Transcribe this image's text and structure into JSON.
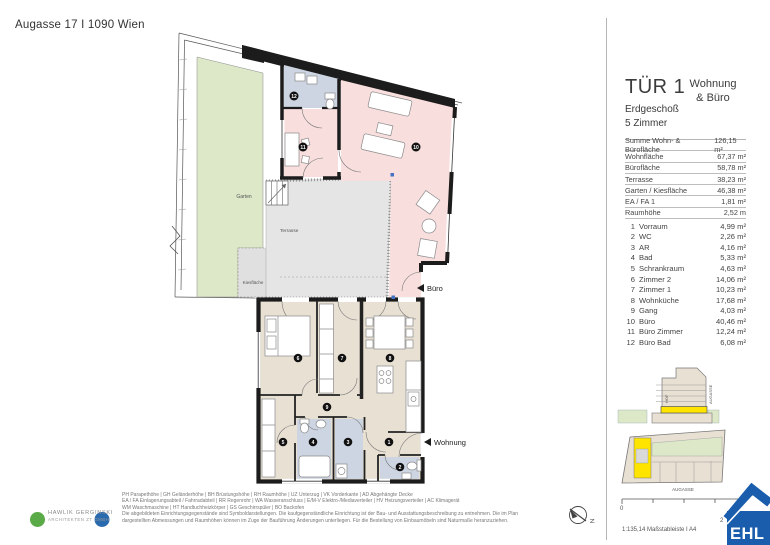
{
  "address": "Augasse 17 I 1090 Wien",
  "panel": {
    "tuer": "TÜR 1",
    "type_line1": "Wohnung",
    "type_line2": "& Büro",
    "floor": "Erdgeschoß",
    "rooms": "5 Zimmer",
    "summary": [
      {
        "label": "Summe Wohn- & Bürofläche",
        "value": "126,15 m²"
      },
      {
        "label": "Wohnfläche",
        "value": "67,37 m²"
      },
      {
        "label": "Bürofläche",
        "value": "58,78 m²"
      },
      {
        "label": "Terrasse",
        "value": "38,23 m²"
      },
      {
        "label": "Garten / Kiesfläche",
        "value": "46,38 m²"
      },
      {
        "label": "EA / FA 1",
        "value": "1,81 m²"
      },
      {
        "label": "Raumhöhe",
        "value": "2,52 m"
      }
    ],
    "room_list": [
      {
        "num": "1",
        "name": "Vorraum",
        "value": "4,99 m²"
      },
      {
        "num": "2",
        "name": "WC",
        "value": "2,26 m²"
      },
      {
        "num": "3",
        "name": "AR",
        "value": "4,16 m²"
      },
      {
        "num": "4",
        "name": "Bad",
        "value": "5,33 m²"
      },
      {
        "num": "5",
        "name": "Schrankraum",
        "value": "4,63 m²"
      },
      {
        "num": "6",
        "name": "Zimmer 2",
        "value": "14,06 m²"
      },
      {
        "num": "7",
        "name": "Zimmer 1",
        "value": "10,23 m²"
      },
      {
        "num": "8",
        "name": "Wohnküche",
        "value": "17,68 m²"
      },
      {
        "num": "9",
        "name": "Gang",
        "value": "4,03 m²"
      },
      {
        "num": "10",
        "name": "Büro",
        "value": "40,46 m²"
      },
      {
        "num": "11",
        "name": "Büro Zimmer",
        "value": "12,24 m²"
      },
      {
        "num": "12",
        "name": "Büro Bad",
        "value": "6,08 m²"
      }
    ],
    "section_diagram": {
      "label_hof": "HOF",
      "label_street": "AUGASSE"
    },
    "site_diagram": {
      "label_street": "AUGASSE"
    }
  },
  "plan": {
    "labels": {
      "garten": "Garten",
      "terrasse": "Terrasse",
      "kiesflaeche": "Kiesfläche",
      "buero": "Büro",
      "wohnung": "Wohnung"
    },
    "room_numbers": [
      "1",
      "2",
      "3",
      "4",
      "5",
      "6",
      "7",
      "8",
      "9",
      "10",
      "11",
      "12"
    ]
  },
  "footer": {
    "architect_line1": "HAWLIK GERGINSKI",
    "architect_line2": "ARCHITEKTEN ZT GMBH",
    "legend_lines": [
      "PH Parapethöhe | GH Geländerhöhe | BH Brüstungshöhe  |  RH Raumhöhe | UZ Unterzug | VK Vorderkante | AD Abgehängte Decke",
      "EA / FA Einlagerungsabteil / Fahrradabteil | RR Regenrohr | WA Wasseranschluss | E/M-V Elektro-/Mediaverteiler | HV Heizungsverteiler | AC Klimagerät",
      "WM Waschmaschine | HT Handtuchheizkörper | GS Geschirrspüler | BO Backofen",
      "Die abgebildeten Einrichtungsgegenstände sind Symboldarstellungen. Die kaufgegenständliche Einrichtung ist der Bau- und Ausstattungsbeschreibung zu entnehmen. Die im Plan",
      "dargestellten Abmessungen und Raumhöhen können im Zuge der Bauführung Änderungen unterliegen. Für die Bestellung von Einbaumöbeln sind Naturmaße heranzuziehen."
    ],
    "scale_text": "1:135,14 Maßstableiste I A4",
    "scale_start": "0",
    "scale_end": "2",
    "north": "N",
    "ehl": "EHL"
  },
  "colors": {
    "buero_pink": "#f9dede",
    "wohnung_beige": "#e8e0d3",
    "garten_green": "#dce8c8",
    "terrasse_grey": "#e5e5e5",
    "bad_blue": "#cdd5e2",
    "highlight_yellow": "#ffe400",
    "wall_black": "#1c1c1c",
    "ehl_blue": "#1a5dad",
    "logo_green": "#5aab47",
    "logo_blue": "#2a6bb0"
  }
}
